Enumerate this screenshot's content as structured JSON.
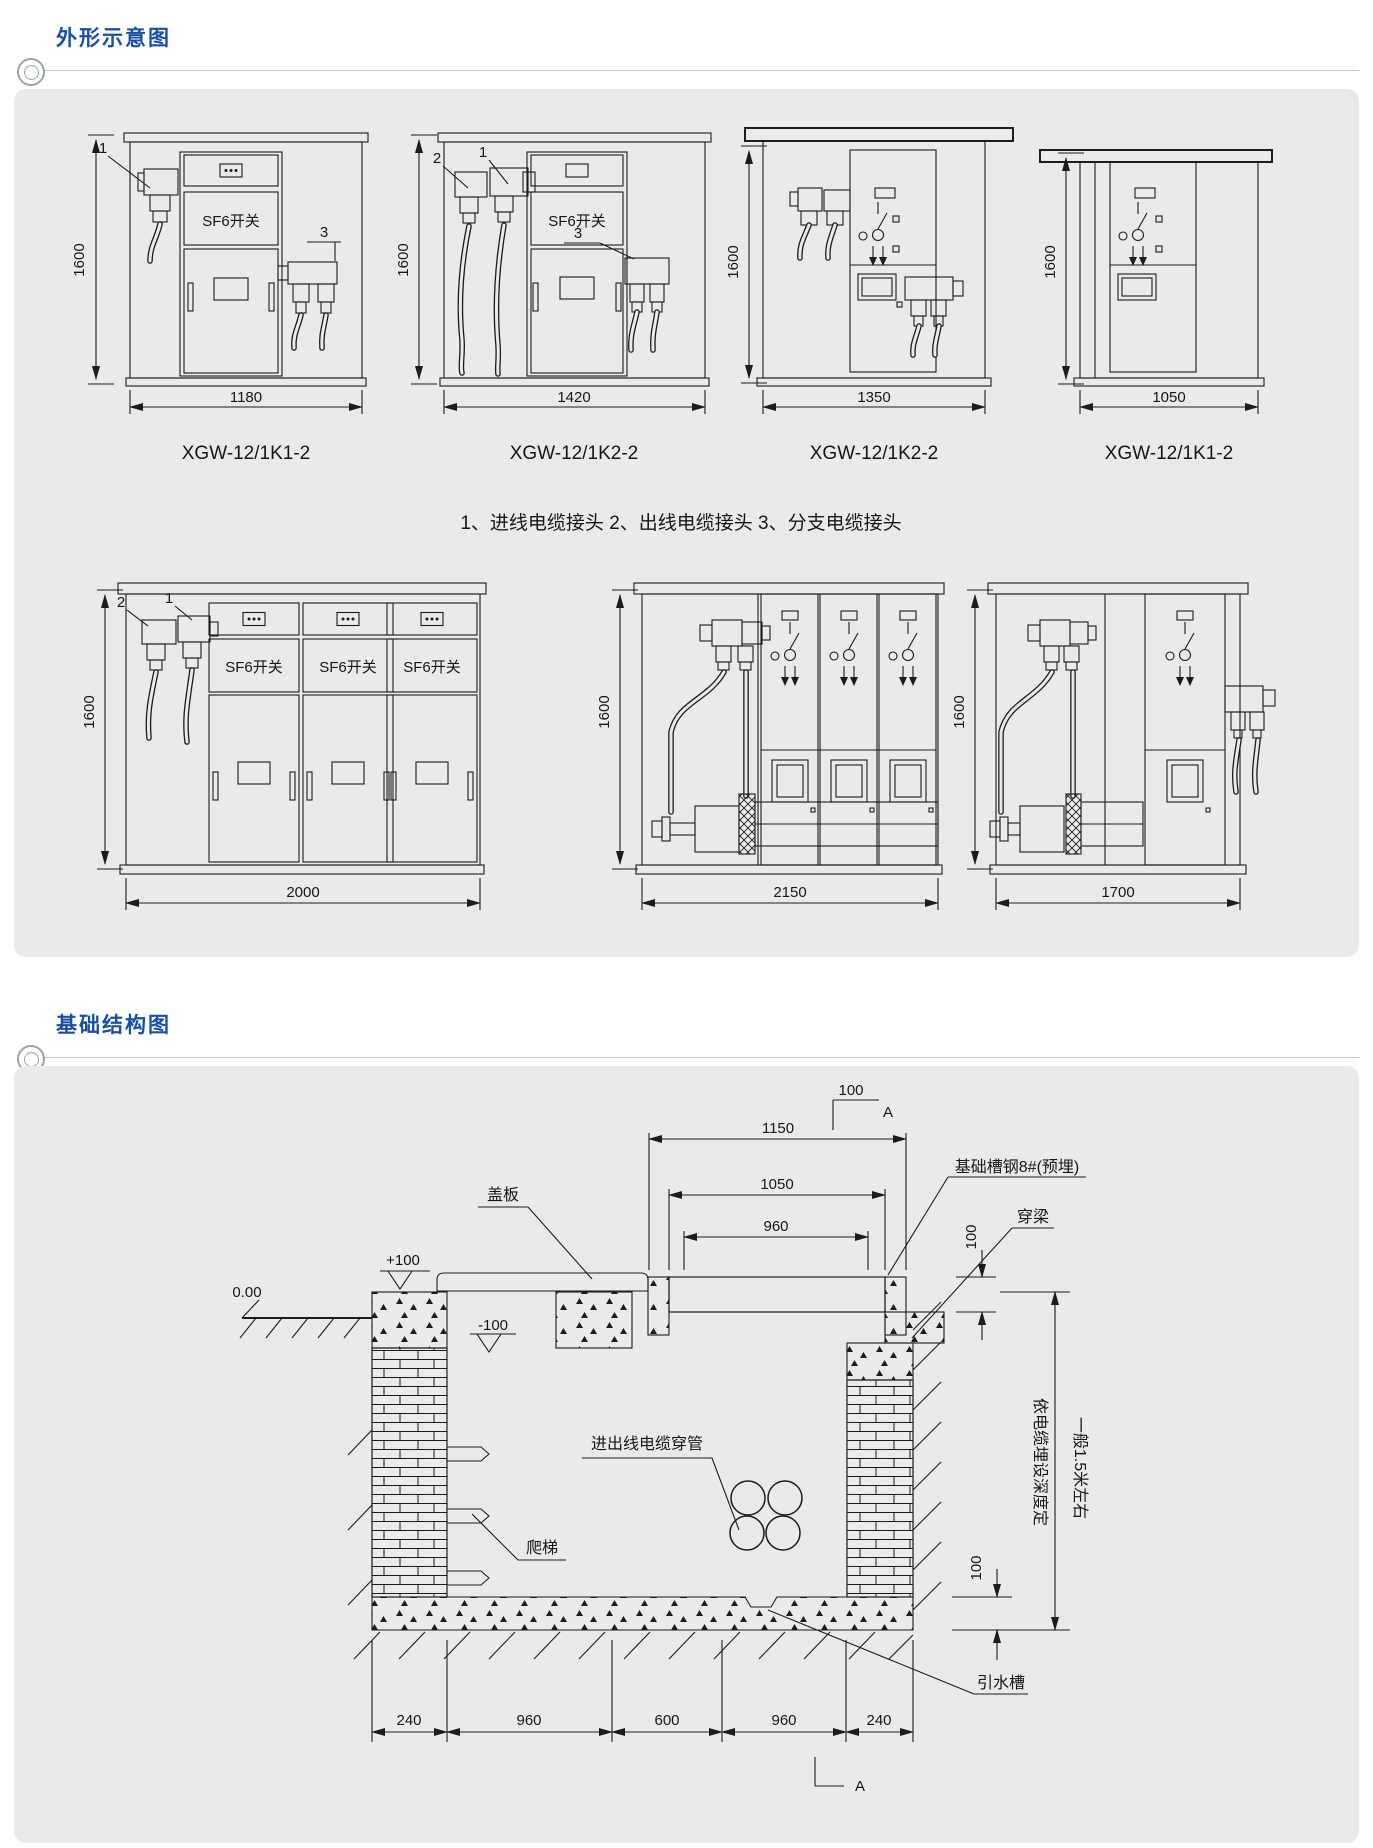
{
  "page": {
    "background": "#ffffff",
    "panel_bg": "#e9eaea",
    "accent": "#1950a4",
    "line": "#1c1c1c"
  },
  "sections": {
    "outline_title": "外形示意图",
    "foundation_title": "基础结构图"
  },
  "outline": {
    "sf6": "SF6开关",
    "legend": "1、进线电缆接头  2、出线电缆接头  3、分支电缆接头",
    "height_dim": "1600",
    "row1": [
      {
        "model": "XGW-12/1K1-2",
        "width_dim": "1180",
        "callout_in": "1",
        "callout_branch": "3"
      },
      {
        "model": "XGW-12/1K2-2",
        "width_dim": "1420",
        "callout_out": "2",
        "callout_in": "1",
        "callout_branch": "3"
      },
      {
        "model": "XGW-12/1K2-2",
        "width_dim": "1350"
      },
      {
        "model": "XGW-12/1K1-2",
        "width_dim": "1050"
      }
    ],
    "row2": [
      {
        "width_dim": "2000",
        "callout_out": "2",
        "callout_in": "1"
      },
      {
        "width_dim": "2150"
      },
      {
        "width_dim": "1700"
      }
    ]
  },
  "foundation": {
    "section_label": "A",
    "top_dim": "100",
    "dim_1150": "1150",
    "dim_1050": "1050",
    "dim_960": "960",
    "label_channel": "基础槽钢8#(预埋)",
    "label_beam": "穿梁",
    "dim_cover": "100",
    "label_cover": "盖板",
    "level_plus": "+100",
    "level_zero": "0.00",
    "level_minus": "-100",
    "label_ladder": "爬梯",
    "label_conduit": "进出线电缆穿管",
    "label_drain": "引水槽",
    "note_depth_1": "依电缆埋设深度定",
    "note_depth_2": "一般1.5米左右",
    "dim_floor": "100",
    "bottom_dims": [
      "240",
      "960",
      "600",
      "960",
      "240"
    ],
    "section_label_bottom": "A"
  }
}
